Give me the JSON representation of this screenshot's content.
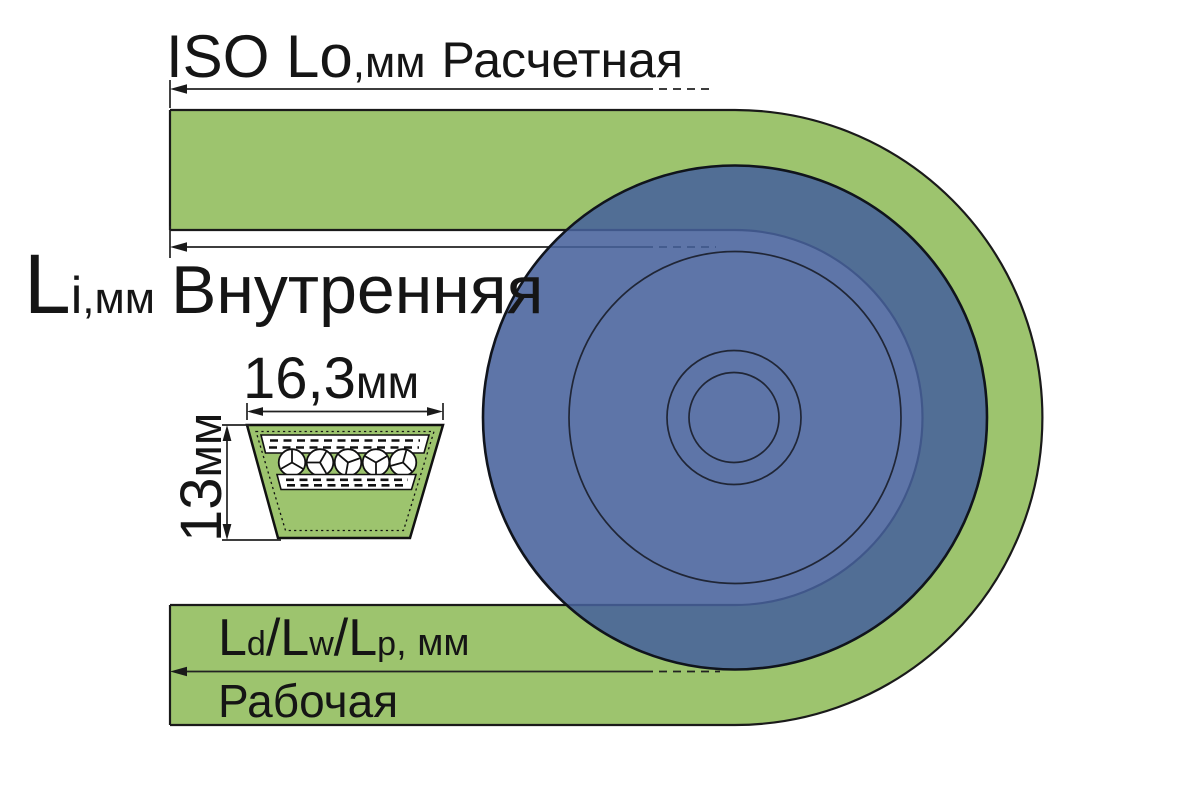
{
  "diagram": {
    "kind": "v-belt length designation diagram",
    "labels": {
      "outer_length": {
        "main": "ISO Lo",
        "unit": ",мм",
        "name": "Расчетная"
      },
      "inner_length": {
        "main": "L",
        "sub": "i",
        "unit": ",мм",
        "name": "Внутренняя"
      },
      "pitch_length": {
        "p1": "L",
        "s1": "d",
        "p2": "/L",
        "s2": "w",
        "p3": "/L",
        "s3": "p",
        "unit": ", мм",
        "name": "Рабочая"
      },
      "cross_section": {
        "width_value": "16,3",
        "width_unit": "мм",
        "height_value": "13",
        "height_unit": "мм"
      }
    },
    "colors": {
      "belt_green": "#9dc46e",
      "pulley_blue": "#46609b",
      "pulley_opacity": "0.87",
      "outline_black": "#1a1a1a"
    }
  }
}
